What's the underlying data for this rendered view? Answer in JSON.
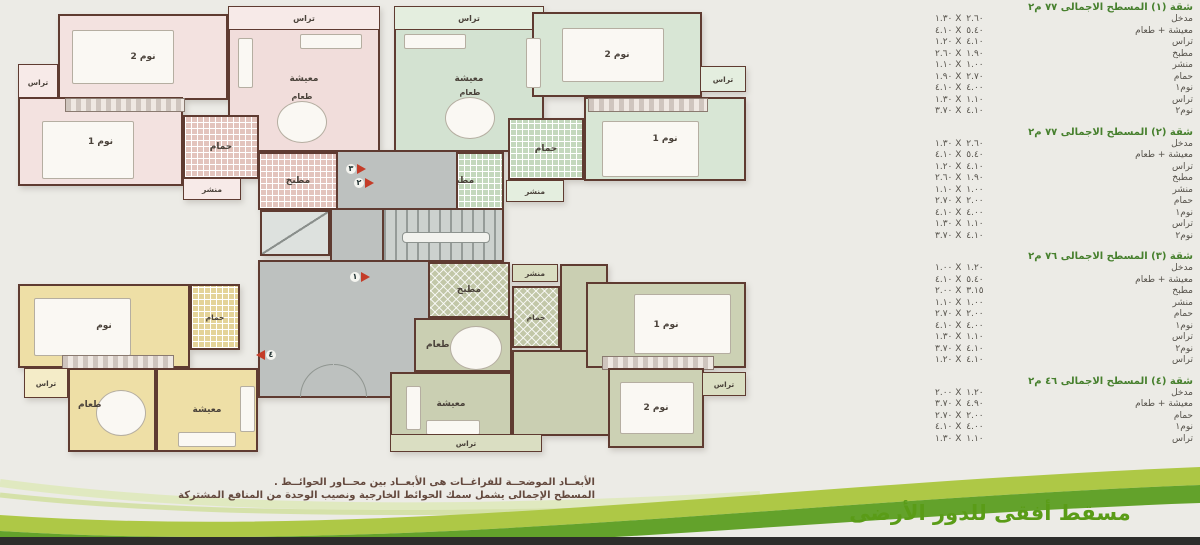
{
  "page": {
    "background": "#ecebe6",
    "footer_title": "مسقط أفقى للدور الأرضى",
    "notes": {
      "line1": "الأبعــاد الموضحــة للفراغــات هى الأبعــاد بين محــاور الحوائــط .",
      "line2": "المسطح الإجمالى يشمل سمك الحوائط الخارجية ونصيب الوحدة من المنافع المشتركة"
    }
  },
  "colors": {
    "wall": "#5f3b31",
    "apartment1_pink": "#f1dddb",
    "apartment2_green": "#d3e2d1",
    "apartment3_olive": "#cacfb2",
    "apartment4_yellow": "#eedfa6",
    "core_gray": "#bdc1bf",
    "table_header_green": "#47802e",
    "title_green": "#5a9c17",
    "band_yellow_green": "#aec846",
    "band_dark_green": "#63a22b",
    "marker_red": "#c43c28"
  },
  "plan": {
    "labels": {
      "terrace": "تراس",
      "bedroom1": "نوم 1",
      "bedroom2": "نوم 2",
      "bedroom": "نوم",
      "living": "معيشة",
      "dining": "طعام",
      "kitchen": "مطبخ",
      "bath": "حمام",
      "laundry": "منشر"
    },
    "markers": {
      "m1": "١",
      "m2": "٢",
      "m3": "٣",
      "m4": "٤"
    }
  },
  "tables": [
    {
      "title": "شقة (١) المسطح الاجمالى ٧٧ م٢",
      "rows": [
        {
          "name": "مدخل",
          "dims": "١.٣٠ X ٢.٦٠"
        },
        {
          "name": "معيشة + طعام",
          "dims": "٤.١٠ X ٥.٤٠"
        },
        {
          "name": "تراس",
          "dims": "١.٢٠ X ٤.١٠"
        },
        {
          "name": "مطبخ",
          "dims": "٢.٦٠ X ١.٩٠"
        },
        {
          "name": "منشر",
          "dims": "١.١٠ X ١.٠٠"
        },
        {
          "name": "حمام",
          "dims": "١.٩٠ X ٢.٧٠"
        },
        {
          "name": "نوم١",
          "dims": "٤.١٠ X ٤.٠٠"
        },
        {
          "name": "تراس",
          "dims": "١.٣٠ X ١.١٠"
        },
        {
          "name": "نوم٢",
          "dims": "٣.٧٠ X ٤.١٠"
        }
      ]
    },
    {
      "title": "شقة (٢) المسطح الاجمالى ٧٧ م٢",
      "rows": [
        {
          "name": "مدخل",
          "dims": "١.٣٠ X ٢.٦٠"
        },
        {
          "name": "معيشة + طعام",
          "dims": "٤.١٠ X ٥.٤٠"
        },
        {
          "name": "تراس",
          "dims": "١.٢٠ X ٤.١٠"
        },
        {
          "name": "مطبخ",
          "dims": "٢.٦٠ X ١.٩٠"
        },
        {
          "name": "منشر",
          "dims": "١.١٠ X ١.٠٠"
        },
        {
          "name": "حمام",
          "dims": "٢.٧٠ X ٢.٠٠"
        },
        {
          "name": "نوم١",
          "dims": "٤.١٠ X ٤.٠٠"
        },
        {
          "name": "تراس",
          "dims": "١.٣٠ X ١.١٠"
        },
        {
          "name": "نوم٢",
          "dims": "٣.٧٠ X ٤.١٠"
        }
      ]
    },
    {
      "title": "شقة (٣) المسطح الاجمالى ٧٦ م٢",
      "rows": [
        {
          "name": "مدخل",
          "dims": "١.٠٠ X ١.٢٠"
        },
        {
          "name": "معيشة + طعام",
          "dims": "٤.١٠ X ٥.٤٠"
        },
        {
          "name": "مطبخ",
          "dims": "٢.٠٠ X ٣.١٥"
        },
        {
          "name": "منشر",
          "dims": "١.١٠ X ١.٠٠"
        },
        {
          "name": "حمام",
          "dims": "٢.٧٠ X ٢.٠٠"
        },
        {
          "name": "نوم١",
          "dims": "٤.١٠ X ٤.٠٠"
        },
        {
          "name": "تراس",
          "dims": "١.٣٠ X ١.١٠"
        },
        {
          "name": "نوم٢",
          "dims": "٣.٧٠ X ٤.١٠"
        },
        {
          "name": "تراس",
          "dims": "١.٢٠ X ٤.١٠"
        }
      ]
    },
    {
      "title": "شقة (٤) المسطح الاجمالى ٤٦ م٢",
      "rows": [
        {
          "name": "مدخل",
          "dims": "٢.٠٠ X ١.٢٠"
        },
        {
          "name": "معيشة + طعام",
          "dims": "٣.٧٠ X ٤.٩٠"
        },
        {
          "name": "حمام",
          "dims": "٢.٧٠ X ٢.٠٠"
        },
        {
          "name": "نوم١",
          "dims": "٤.١٠ X ٤.٠٠"
        },
        {
          "name": "تراس",
          "dims": "١.٣٠ X ١.١٠"
        }
      ]
    }
  ]
}
